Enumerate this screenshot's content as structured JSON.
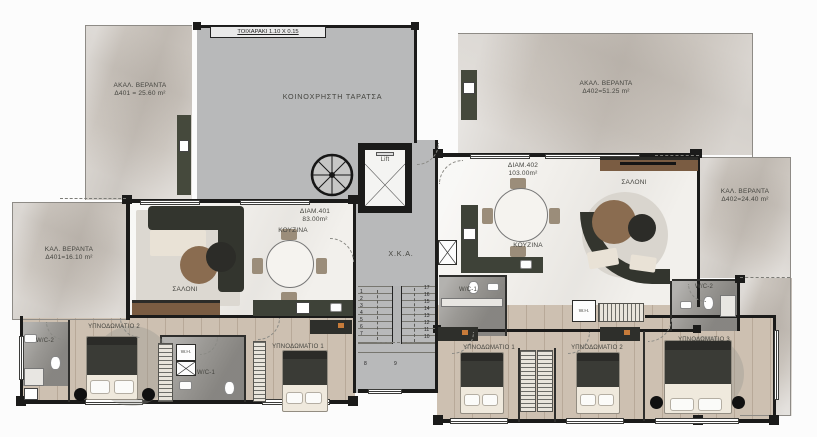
{
  "colors": {
    "wall": "#1b1b1a",
    "terrace_gray": "#b8b9ba",
    "veranda_marble": "#cbc5be",
    "interior_marble": "#f2f0ec",
    "bedroom_wood": "#cdc0b1",
    "bath_marble": "#9a9894",
    "cabinet_green": "#3e4238",
    "text": "#44443f"
  },
  "common": {
    "terrace_label": "ΚΟΙΝΟΧΡΗΣΤΗ ΤΑΡΑΤΣΑ",
    "wall_note": "ΤΟΙΧΑΡΑΚΙ 1.10 Χ 0.15",
    "lift_label": "Lift",
    "corridor_label": "Χ.Κ.Α."
  },
  "verandas": {
    "top_left": {
      "line1": "ΑΚΑΛ. ΒΕΡΑΝΤΑ",
      "line2": "Δ401 = 25.60 m²"
    },
    "top_right": {
      "line1": "ΑΚΑΛ. ΒΕΡΑΝΤΑ",
      "line2": "Δ402=51.25 m²"
    },
    "left": {
      "line1": "ΚΑΛ. ΒΕΡΑΝΤΑ",
      "line2": "Δ401=16.10 m²"
    },
    "right": {
      "line1": "ΚΑΛ. ΒΕΡΑΝΤΑ",
      "line2": "Δ402=24.40 m²"
    }
  },
  "apt401": {
    "name": "ΔΙΑΜ.401",
    "area": "83.00m²",
    "living": "ΣΑΛΟΝΙ",
    "kitchen": "ΚΟΥΖΙΝΑ",
    "bedroom1": "ΥΠΝΟΔΩΜΑΤΙΟ 1",
    "bedroom2": "ΥΠΝΟΔΩΜΑΤΙΟ 2",
    "wc1": "W/C-1",
    "wc2": "W/C-2",
    "water_heater": "W.H."
  },
  "apt402": {
    "name": "ΔΙΑΜ.402",
    "area": "103.00m²",
    "living": "ΣΑΛΟΝΙ",
    "kitchen": "ΚΟΥΖΙΝΑ",
    "bedroom1": "ΥΠΝΟΔΩΜΑΤΙΟ 1",
    "bedroom2": "ΥΠΝΟΔΩΜΑΤΙΟ 2",
    "bedroom3": "ΥΠΝΟΔΩΜΑΤΙΟ 3",
    "wc1": "W/C-1",
    "wc2": "W/C-2",
    "water_heater": "W.H."
  },
  "stairs": {
    "left": [
      "1",
      "2",
      "3",
      "4",
      "5",
      "6",
      "7"
    ],
    "right": [
      "17",
      "16",
      "15",
      "14",
      "13",
      "12",
      "11",
      "10"
    ],
    "bottom": [
      "8",
      "9"
    ]
  }
}
